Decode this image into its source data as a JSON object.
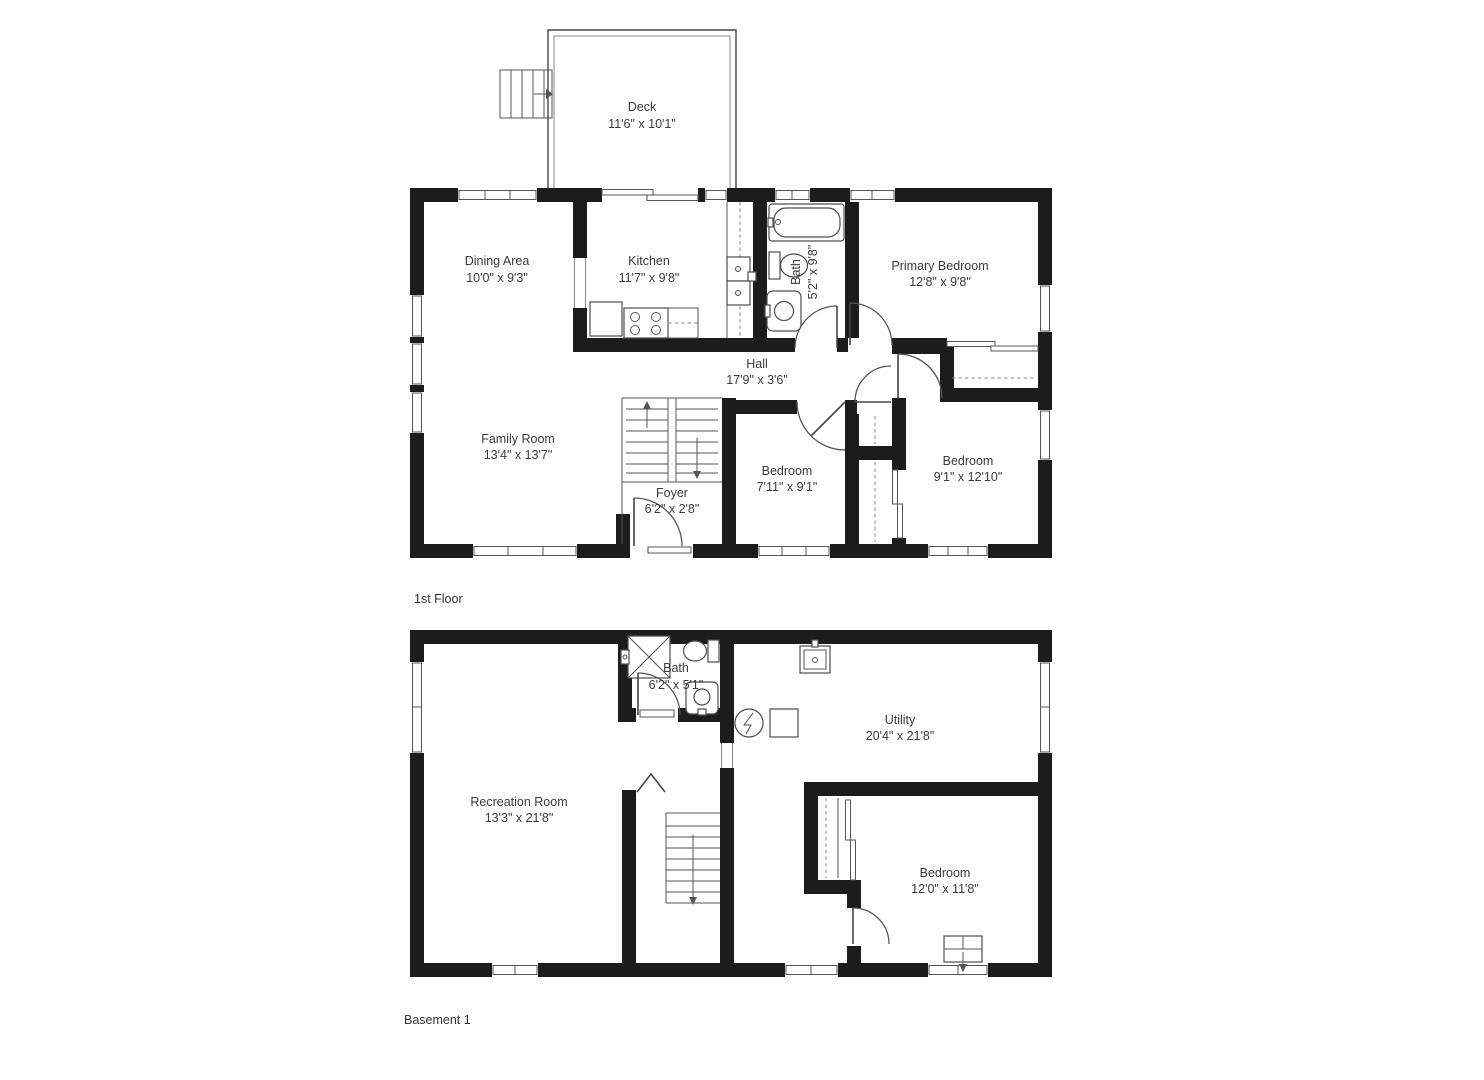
{
  "first_floor": {
    "label": "1st Floor",
    "deck": {
      "name": "Deck",
      "dims": "11'6\" x 10'1\""
    },
    "dining": {
      "name": "Dining Area",
      "dims": "10'0\" x 9'3\""
    },
    "kitchen": {
      "name": "Kitchen",
      "dims": "11'7\" x 9'8\""
    },
    "bath": {
      "name": "Bath",
      "dims": "5'2\" x 9'8\""
    },
    "primary_bedroom": {
      "name": "Primary Bedroom",
      "dims": "12'8\" x 9'8\""
    },
    "hall": {
      "name": "Hall",
      "dims": "17'9\" x 3'6\""
    },
    "family_room": {
      "name": "Family Room",
      "dims": "13'4\" x 13'7\""
    },
    "foyer": {
      "name": "Foyer",
      "dims": "6'2\" x 2'8\""
    },
    "bedroom_center": {
      "name": "Bedroom",
      "dims": "7'11\" x 9'1\""
    },
    "bedroom_right": {
      "name": "Bedroom",
      "dims": "9'1\" x 12'10\""
    }
  },
  "basement": {
    "label": "Basement 1",
    "bath": {
      "name": "Bath",
      "dims": "6'2\" x 5'1\""
    },
    "utility": {
      "name": "Utility",
      "dims": "20'4\" x 21'8\""
    },
    "recreation_room": {
      "name": "Recreation Room",
      "dims": "13'3\" x 21'8\""
    },
    "bedroom": {
      "name": "Bedroom",
      "dims": "12'0\" x 11'8\""
    }
  },
  "colors": {
    "wall": "#1c1c1c",
    "line": "#555555",
    "text": "#3a3a3a",
    "background": "#ffffff"
  }
}
